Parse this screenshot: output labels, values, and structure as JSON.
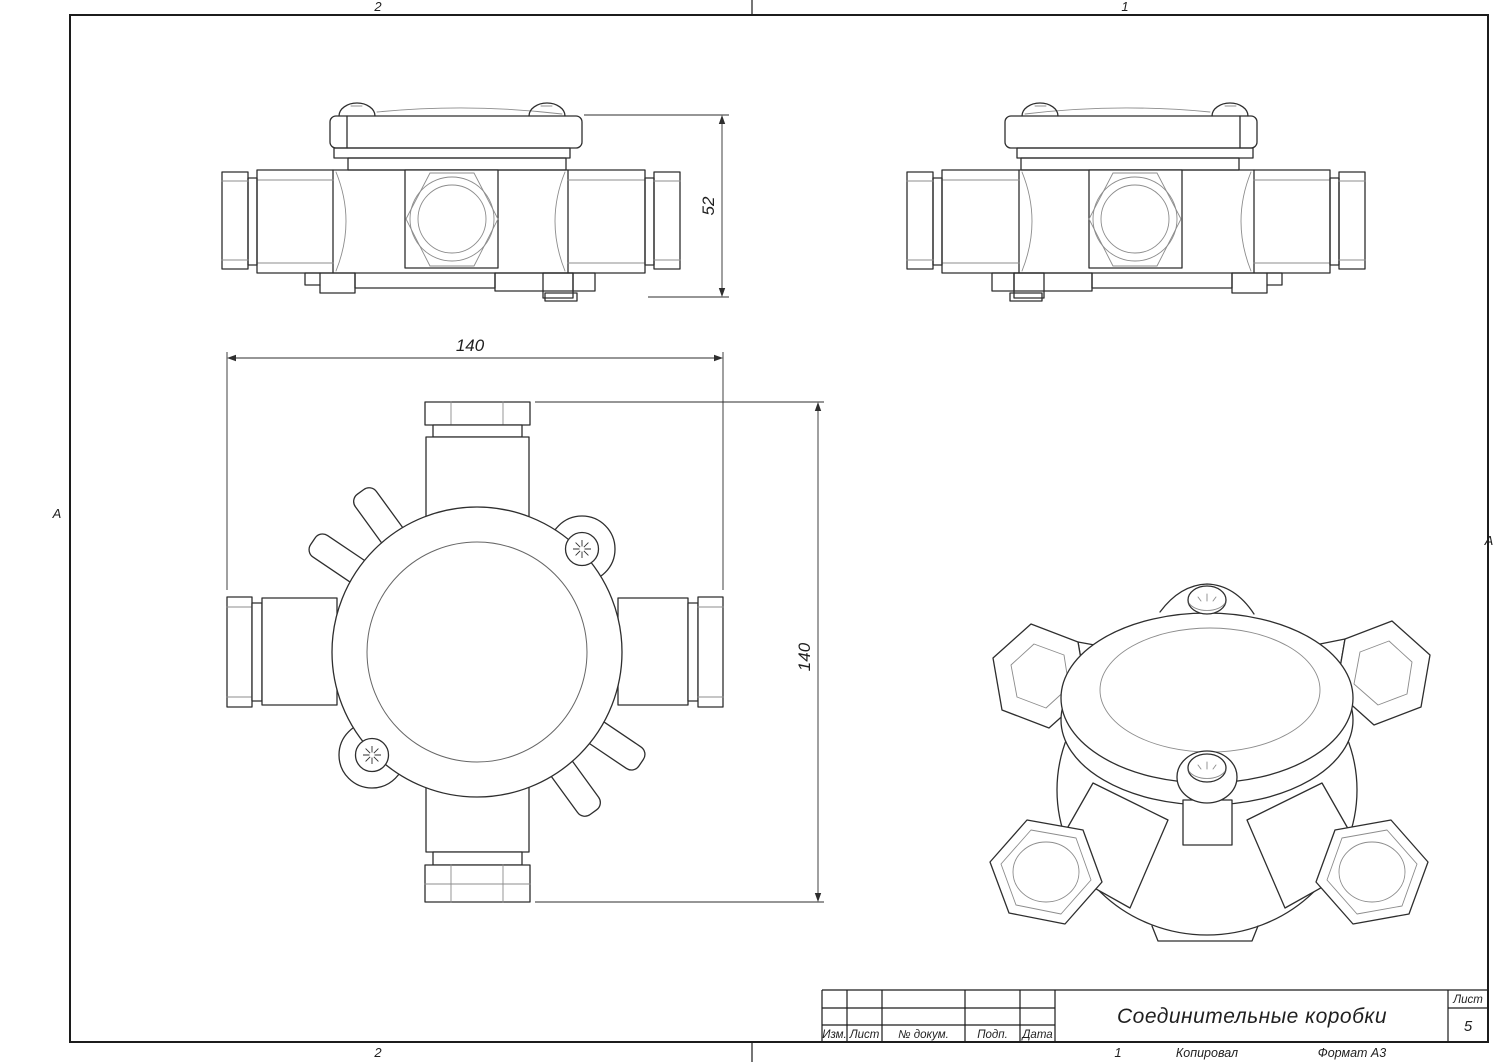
{
  "frame": {
    "zone_top_left": "2",
    "zone_top_right": "1",
    "zone_bottom_left": "2",
    "zone_bottom_right": "1",
    "row_left": "А",
    "row_right": "А"
  },
  "dimensions": {
    "front_height": "52",
    "plan_width": "140",
    "plan_height": "140"
  },
  "title_block": {
    "title": "Соединительные коробки",
    "col_izm": "Изм.",
    "col_list": "Лист",
    "col_docnum": "№ докум.",
    "col_podp": "Подп.",
    "col_data": "Дата",
    "sheet_label": "Лист",
    "sheet_number": "5"
  },
  "footer": {
    "copied": "Копировал",
    "format": "Формат А3"
  }
}
